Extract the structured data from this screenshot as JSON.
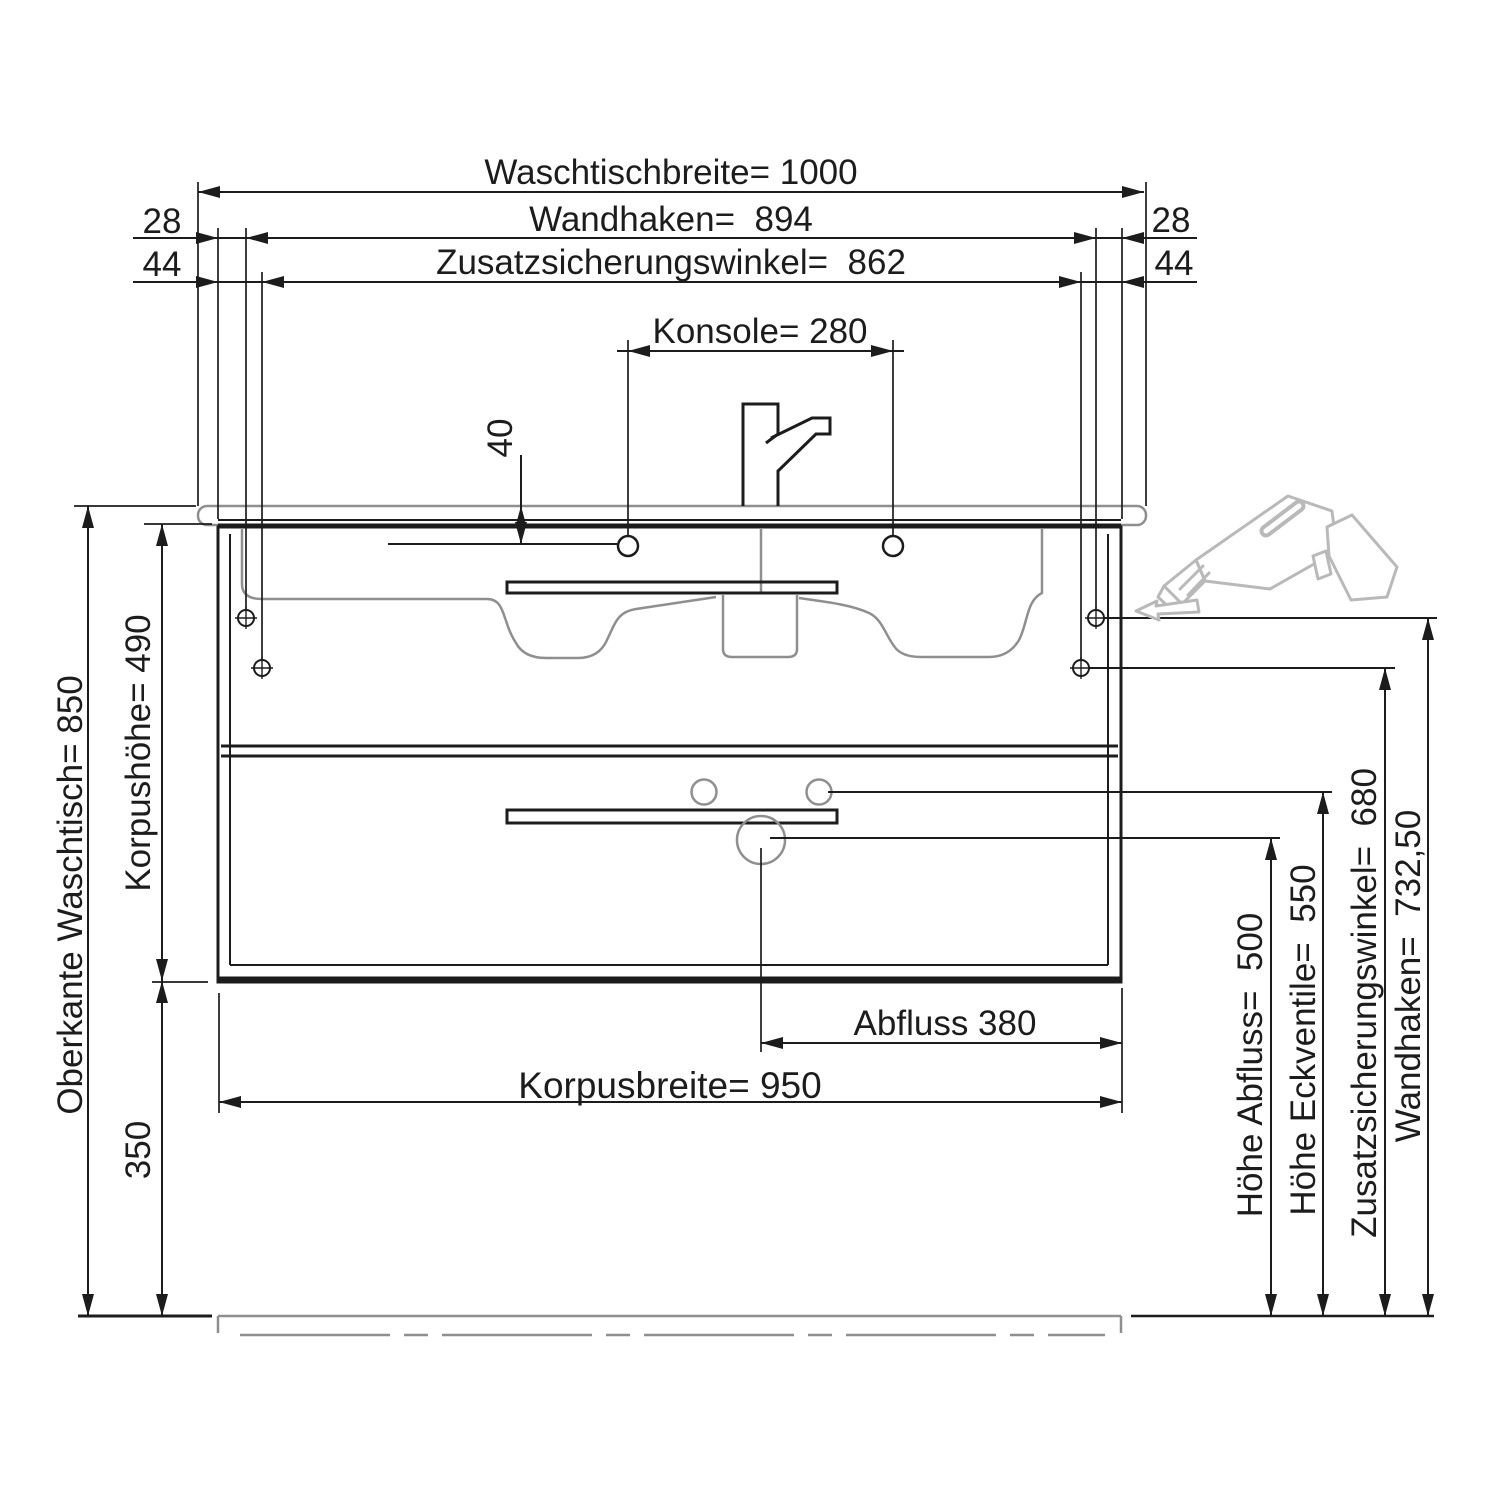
{
  "colors": {
    "line": "#1c1c1c",
    "ghost": "#8f8f8f",
    "clipart": "#b9b9b9",
    "bg": "#ffffff"
  },
  "dims": {
    "top": {
      "waschtischbreite": "Waschtischbreite= 1000",
      "wandhaken": "Wandhaken=  894",
      "zusatzsicherungswinkel": "Zusatzsicherungswinkel=  862",
      "konsole": "Konsole= 280",
      "offset_28_left": "28",
      "offset_28_right": "28",
      "offset_44_left": "44",
      "offset_44_right": "44",
      "faucet_hole_offset": "40"
    },
    "left": {
      "oberkante_waschtisch": "Oberkante Waschtisch= 850",
      "korpushoehe": "Korpushöhe= 490",
      "bodenabstand": "350"
    },
    "bottom": {
      "abfluss": "Abfluss 380",
      "korpusbreite": "Korpusbreite= 950"
    },
    "right": {
      "hoehe_abfluss": "Höhe Abfluss=  500",
      "hoehe_eckventile": "Höhe Eckventile=  550",
      "zusatzsicherungswinkel": "Zusatzsicherungswinkel=  680",
      "wandhaken": "Wandhaken=  732,50"
    }
  }
}
